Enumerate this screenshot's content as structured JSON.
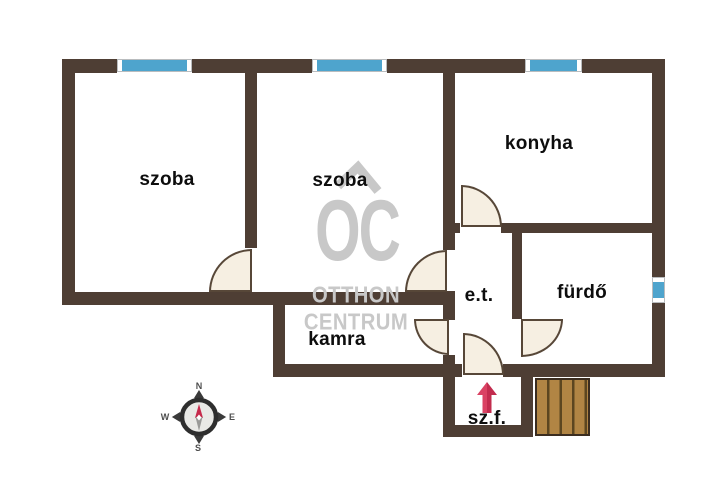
{
  "plan": {
    "rooms": [
      {
        "key": "szoba-left",
        "label": "szoba"
      },
      {
        "key": "szoba-middle",
        "label": "szoba"
      },
      {
        "key": "konyha",
        "label": "konyha"
      },
      {
        "key": "eloter",
        "label": "e.t."
      },
      {
        "key": "furdo",
        "label": "fürdő"
      },
      {
        "key": "kamra",
        "label": "kamra"
      },
      {
        "key": "szelfogo",
        "label": "sz.f."
      }
    ],
    "entrance_direction": "up"
  },
  "watermark": {
    "logo": "OC",
    "line1": "OTTHON",
    "line2": "CENTRUM"
  },
  "compass": {
    "n": "N",
    "e": "E",
    "s": "S",
    "w": "W"
  },
  "colors": {
    "wall": "#4e3e34",
    "window_glass": "#4ea4cd",
    "door_fill": "#f6efe2",
    "door_stroke": "#574738",
    "stairs_fill": "#b18544",
    "stairs_line": "#5c4620",
    "entrance_arrow": "#d63b5b",
    "watermark": "#c8c8c8",
    "label_text": "#0d0d0d"
  }
}
